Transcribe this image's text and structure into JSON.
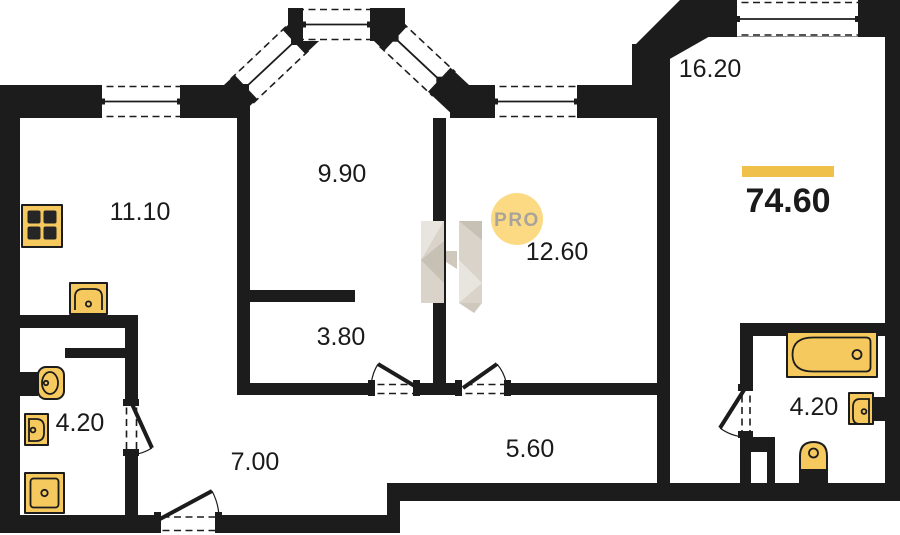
{
  "plan": {
    "rooms": [
      {
        "id": "kitchen",
        "area": "11.10"
      },
      {
        "id": "bay-room",
        "area": "9.90"
      },
      {
        "id": "bedroom",
        "area": "16.20"
      },
      {
        "id": "room",
        "area": "12.60"
      },
      {
        "id": "inner-corridor",
        "area": "3.80"
      },
      {
        "id": "bathroom-left",
        "area": "4.20"
      },
      {
        "id": "hallway",
        "area": "7.00"
      },
      {
        "id": "corridor",
        "area": "5.60"
      },
      {
        "id": "bathroom-right",
        "area": "4.20"
      }
    ],
    "total_area": "74.60",
    "watermark": {
      "badge_text": "PRO"
    },
    "icons": [
      "stove-icon",
      "kitchen-sink-icon",
      "toilet-icon",
      "washbasin-icon",
      "shower-icon",
      "bathtub-icon"
    ],
    "colors": {
      "wall": "#1c1c1c",
      "fixture_fill": "#f6c95f",
      "accent_bar": "#efc04a",
      "badge_bg": "#fcda83",
      "badge_text": "#a8a39b",
      "label_text": "#1a1a1a"
    }
  }
}
